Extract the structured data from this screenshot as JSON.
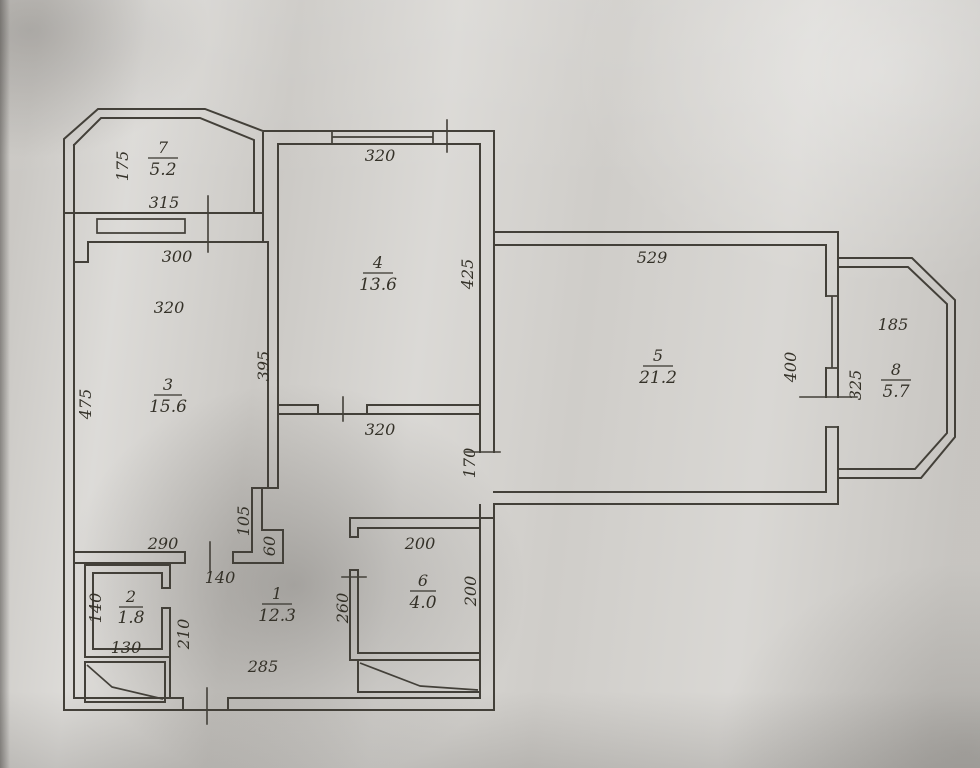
{
  "drawing": {
    "type": "apartment floor plan",
    "line_color": "#434039",
    "text_color": "#343128",
    "paper_color": "#d4d2ce"
  },
  "rooms": [
    {
      "number": "1",
      "area": "12.3"
    },
    {
      "number": "2",
      "area": "1.8"
    },
    {
      "number": "3",
      "area": "15.6"
    },
    {
      "number": "4",
      "area": "13.6"
    },
    {
      "number": "5",
      "area": "21.2"
    },
    {
      "number": "6",
      "area": "4.0"
    },
    {
      "number": "7",
      "area": "5.2"
    },
    {
      "number": "8",
      "area": "5.7"
    }
  ],
  "dims": [
    {
      "name": "balcony7-depth",
      "value": "175"
    },
    {
      "name": "balcony7-width",
      "value": "315"
    },
    {
      "name": "room3-top-wall",
      "value": "300"
    },
    {
      "name": "room3-width",
      "value": "320"
    },
    {
      "name": "room3-height",
      "value": "475"
    },
    {
      "name": "room3-right-height",
      "value": "395"
    },
    {
      "name": "room3-bottom",
      "value": "290"
    },
    {
      "name": "room4-width",
      "value": "320"
    },
    {
      "name": "room4-height",
      "value": "425"
    },
    {
      "name": "hall-width",
      "value": "320"
    },
    {
      "name": "hall-room5-opening",
      "value": "170"
    },
    {
      "name": "room5-width",
      "value": "529"
    },
    {
      "name": "room5-height",
      "value": "400"
    },
    {
      "name": "balcony8-width",
      "value": "185"
    },
    {
      "name": "balcony8-height",
      "value": "325"
    },
    {
      "name": "room1-nook-depth",
      "value": "105"
    },
    {
      "name": "room1-nook-width",
      "value": "60"
    },
    {
      "name": "room1-door-offset",
      "value": "140"
    },
    {
      "name": "room1-height",
      "value": "210"
    },
    {
      "name": "room1-width",
      "value": "285"
    },
    {
      "name": "room6-wall-offset",
      "value": "260"
    },
    {
      "name": "room2-height",
      "value": "140"
    },
    {
      "name": "room2-width",
      "value": "130"
    },
    {
      "name": "room6-width",
      "value": "200"
    },
    {
      "name": "room6-height",
      "value": "200"
    }
  ]
}
